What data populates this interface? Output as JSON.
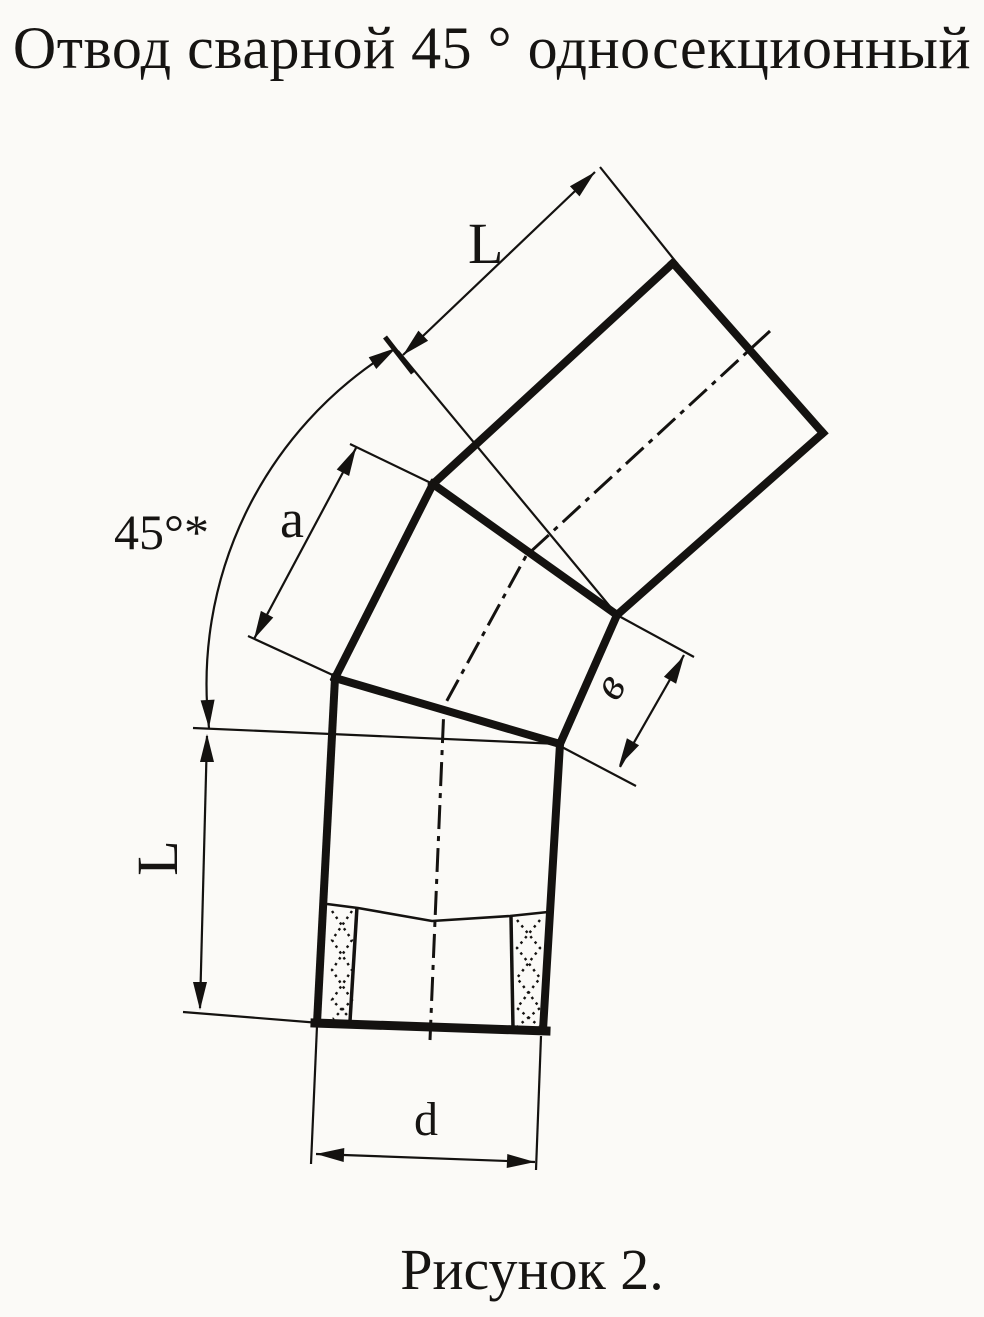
{
  "title": "Отвод сварной 45 ° односекционный",
  "figure_caption": "Рисунок 2.",
  "drawing": {
    "subject": "welded 45-degree single-section pipe elbow, side view with weld seams, socket hatching and centerlines",
    "labels": {
      "length_top": "L",
      "length_bottom": "L",
      "miter_width": "a",
      "angle": "45°*",
      "inner_width": "в",
      "diameter": "d"
    }
  },
  "colors": {
    "ink": "#141210",
    "paper": "#fbfaf7"
  }
}
